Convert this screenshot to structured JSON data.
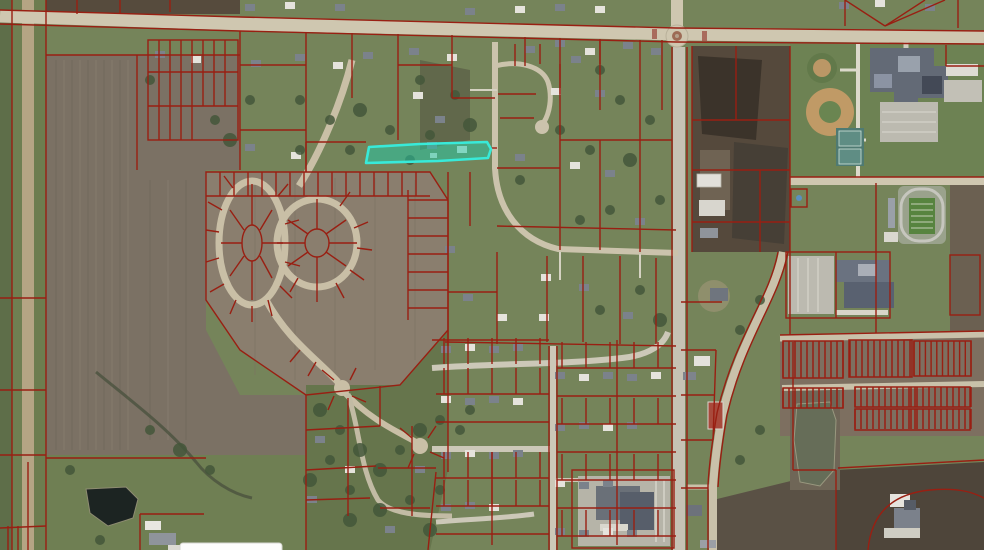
{
  "map": {
    "view": "aerial-parcel-map",
    "selected_parcel": {
      "state": "highlighted",
      "stroke": "#38ead9",
      "fill": "#1fc9a7",
      "fill_opacity": "0.5"
    },
    "layers": {
      "parcel_line_color": "#991f12",
      "parcel_line_width": "1.4"
    },
    "popup": {
      "background": "#fcfcfb",
      "border": "#d6d6d0"
    }
  }
}
